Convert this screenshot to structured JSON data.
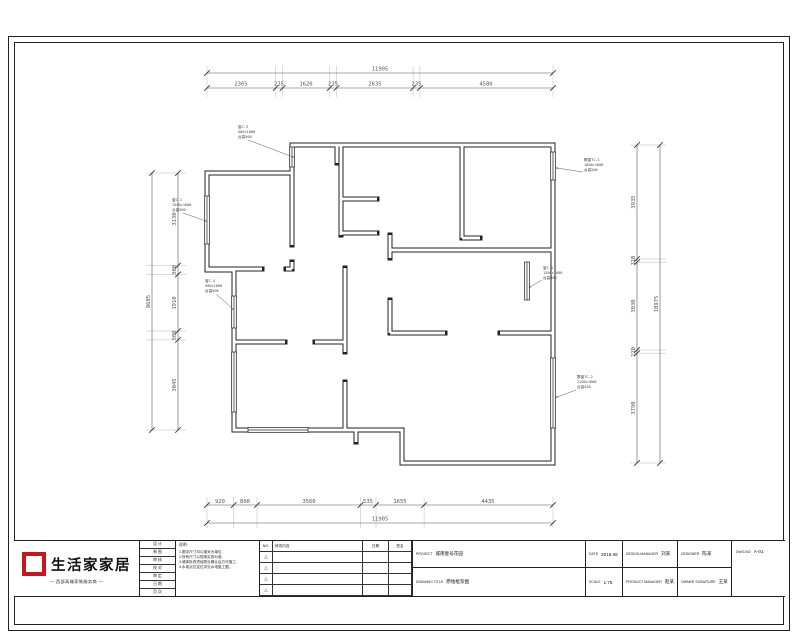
{
  "dimensions": {
    "top": {
      "total": "11905",
      "segments": [
        "2365",
        "235",
        "1620",
        "235",
        "2635",
        "235",
        "4580"
      ]
    },
    "bottom": {
      "total": "11905",
      "segments": [
        "920",
        "800",
        "3560",
        "535",
        "1655",
        "4435"
      ]
    },
    "left": {
      "total": "8685",
      "segments": [
        "3130",
        "300",
        "1910",
        "300",
        "3045"
      ]
    },
    "right": {
      "total": "10975",
      "segments": [
        "3935",
        "110",
        "3030",
        "110",
        "3790"
      ]
    }
  },
  "annotations": [
    {
      "lines": [
        "窗C-3",
        "600×1600",
        "台高900"
      ]
    },
    {
      "lines": [
        "窗C-1",
        "1500×1600",
        "台高900"
      ]
    },
    {
      "lines": [
        "窗C-4",
        "900×1600",
        "台高900"
      ]
    },
    {
      "lines": [
        "飘窗TC-1",
        "1800×1600",
        "台高500"
      ]
    },
    {
      "lines": [
        "窗C-5",
        "1200×1600",
        "台高900"
      ]
    },
    {
      "lines": [
        "飘窗TC-2",
        "2100×1600",
        "台高450"
      ]
    }
  ],
  "logo": {
    "brand": "生活家家居",
    "tagline": "— 西部高端家装服务商 —",
    "accent_color": "#c8161d"
  },
  "titleblock": {
    "crew_rows": [
      "设 计",
      "制 图",
      "审 核",
      "校 对",
      "审 定",
      "日 期",
      "页 次"
    ],
    "notes": {
      "title": "说明:",
      "lines": [
        "1.图中尺寸均以毫米为单位;",
        "2.所有尺寸以现场实测为准;",
        "3.墙体拆改须经物业确认后方可施工;",
        "4.水电点位定位详见水电施工图。"
      ]
    },
    "revision": {
      "headers": [
        "NO.",
        "修改内容",
        "日期",
        "签名"
      ],
      "mark": "△"
    },
    "fields": {
      "project_label": "PROJECT",
      "project_value": "城南壹号花园",
      "drawing_title_label": "DRAWING TITLE",
      "drawing_title_value": "原始框架图",
      "date_label": "DATE",
      "date_value": "2016.06",
      "scale_label": "SCALE",
      "scale_value": "1:75",
      "design_manager_label": "DESIGN MANAGER",
      "design_manager_value": "刘某",
      "designer_label": "DESIGNER",
      "designer_value": "陈某",
      "product_manager_label": "PRODUCT MANAGER",
      "product_manager_value": "赵某",
      "owner_signature_label": "OWNER SIGNATURE",
      "owner_signature_value": "王某",
      "dwgno_label": "DWG.NO",
      "dwgno_value": "A-01"
    }
  }
}
